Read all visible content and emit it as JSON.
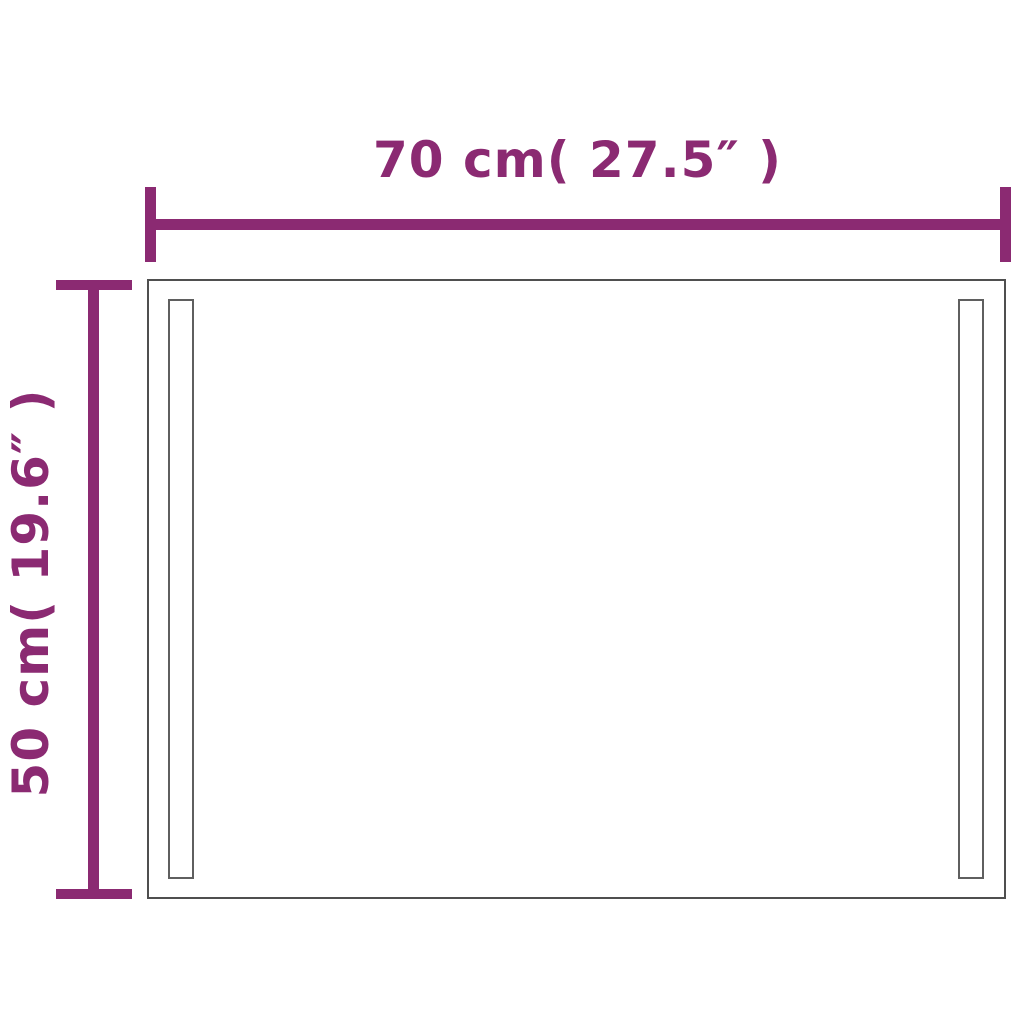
{
  "diagram": {
    "horizontal_dimension": {
      "label": "70 cm( 27.5″ )",
      "value_cm": 70,
      "value_inches": 27.5
    },
    "vertical_dimension": {
      "label": "50 cm( 19.6″ )",
      "value_cm": 50,
      "value_inches": 19.6
    },
    "colors": {
      "dimension_line": "#8B2A72",
      "mirror_outline": "#4f4f4f",
      "led_strip_outline": "#5f5f5f",
      "background": "#ffffff"
    }
  }
}
